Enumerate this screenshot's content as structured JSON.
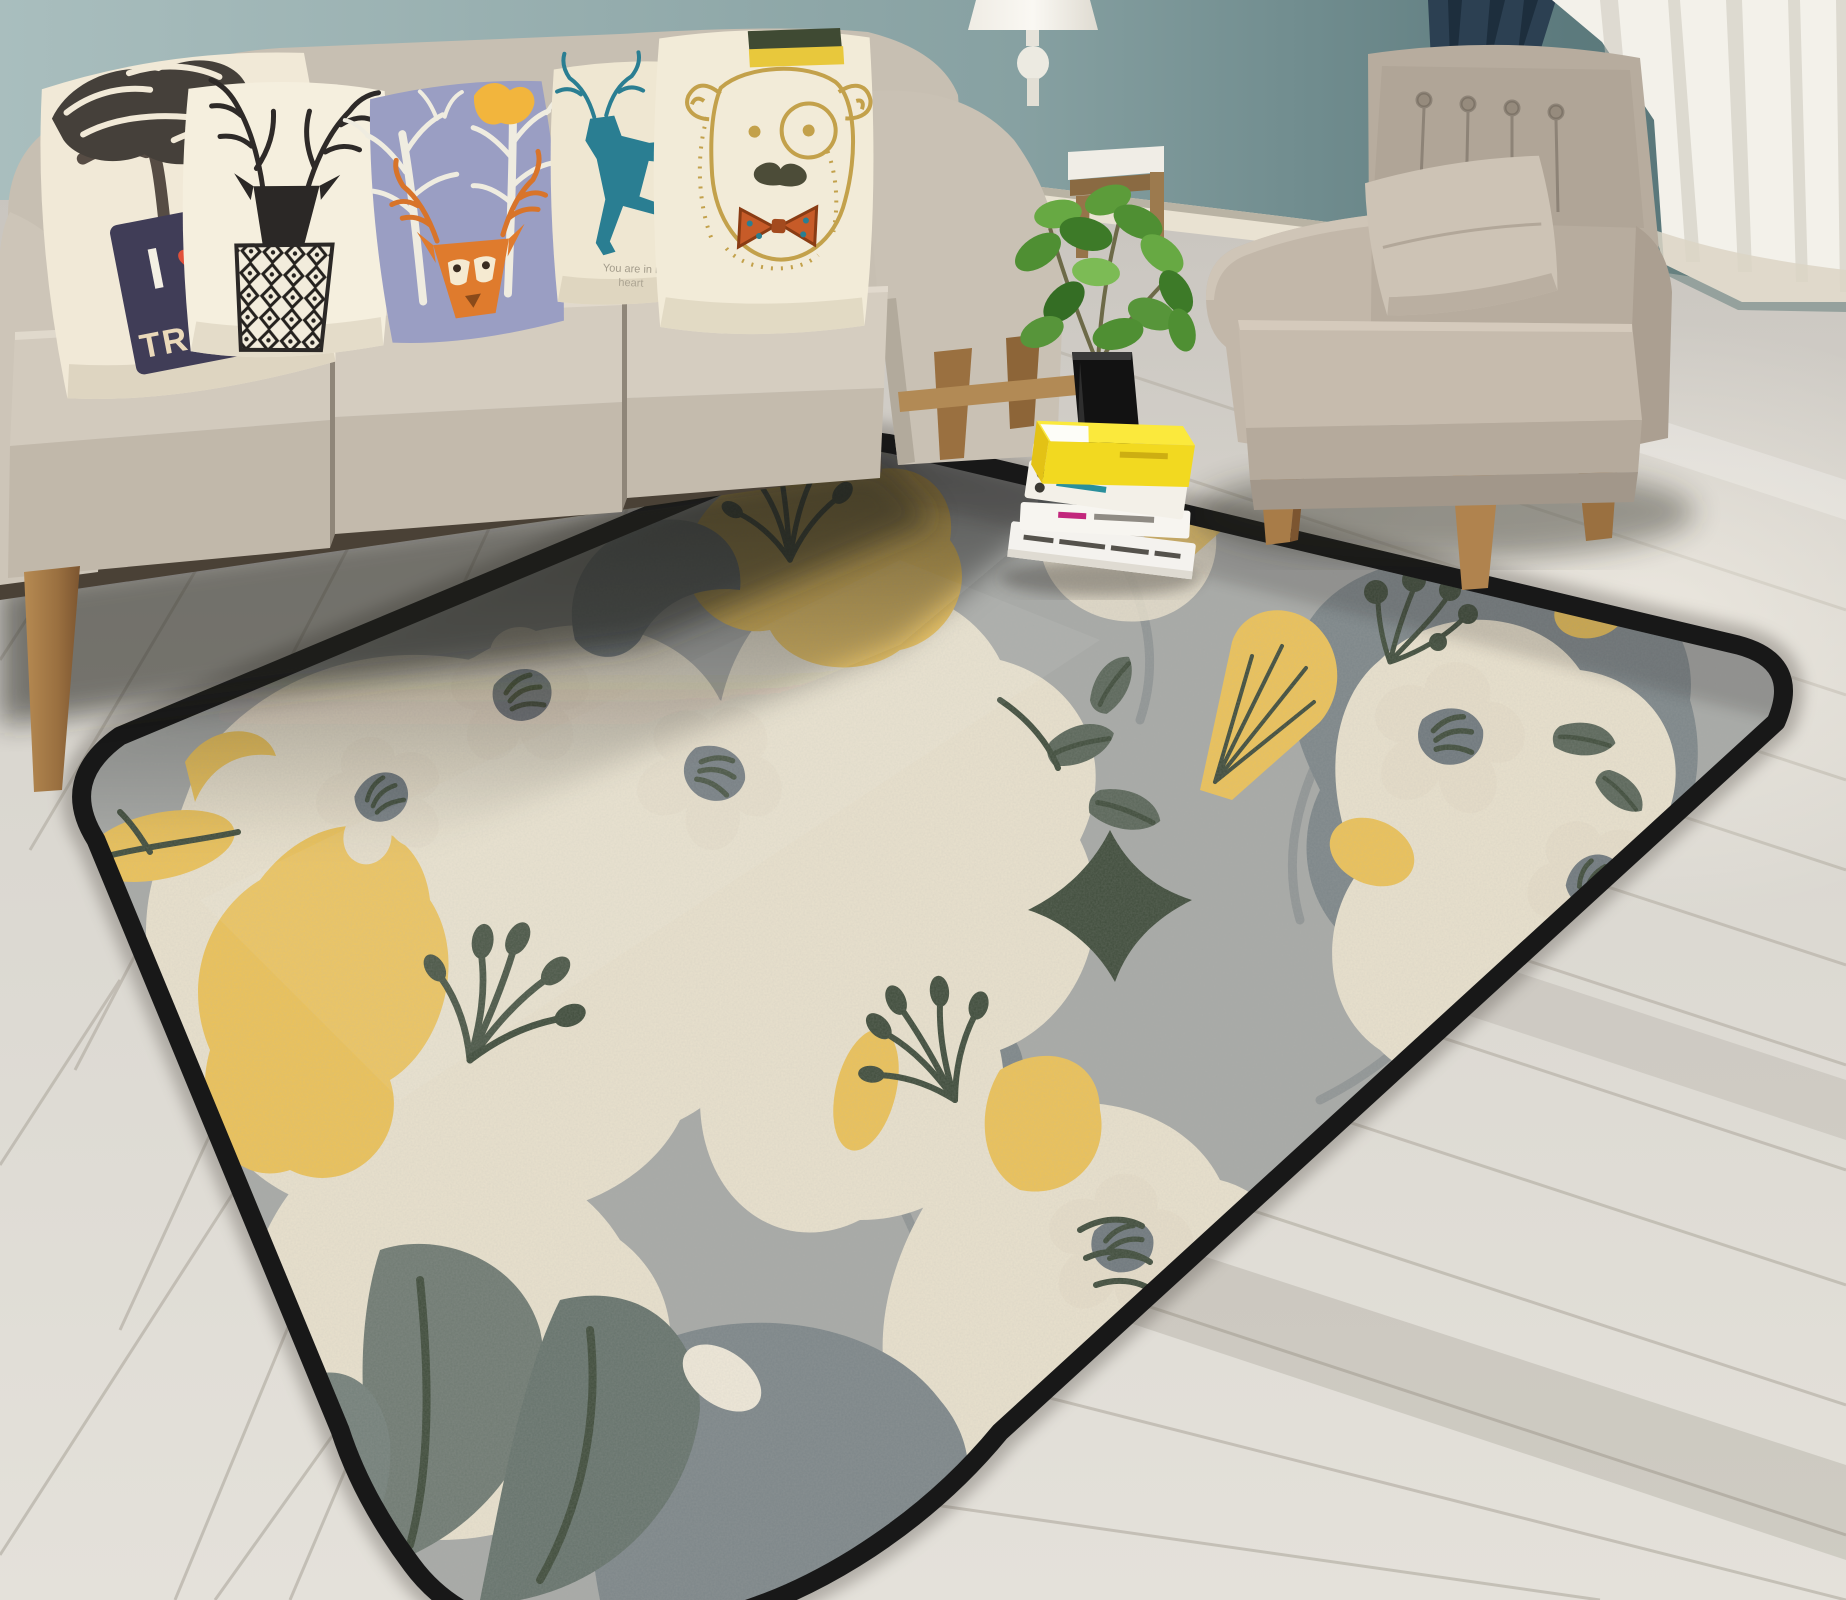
{
  "scene": {
    "description": "living room product photo of a floral area rug",
    "objects": [
      "sofa",
      "throw-pillows",
      "armchair",
      "table-lamp",
      "side-table",
      "potted-plant",
      "book-stack",
      "floral-area-rug",
      "sheer-curtain",
      "dark-curtain",
      "wood-floor"
    ]
  },
  "pillow_tree": {
    "line1": "I",
    "heart": "♥",
    "line2": "TREES"
  },
  "pillow_deer": {
    "caption1": "You are in my",
    "caption2": "heart"
  },
  "palette": {
    "wall-left": "#a7bcbb",
    "wall-right": "#5c7a7d",
    "baseboard": "#e9e2d2",
    "floor": "#dcd8d1",
    "floor-line": "#b8b3a9",
    "curtain-dark": "#2c4052",
    "curtain-light": "#f3f1ea",
    "rug-gray": "#a7a9a6",
    "rug-cream": "#e9e1cd",
    "rug-yellow": "#ecc258",
    "rug-slate": "#7d8689",
    "rug-dkgreen": "#3f4c3b",
    "rug-border": "#181818",
    "sofa": "#c7bfb2",
    "chair": "#b7ac9e",
    "wood": "#a87c48",
    "planter": "#121212",
    "book-yellow": "#f2dd2e",
    "deer-teal": "#2a7e92",
    "pillow-lavender": "#9a9ec3",
    "fox-orange": "#df7b2d",
    "badge-navy": "#403d57",
    "heart-red": "#e1503a"
  }
}
